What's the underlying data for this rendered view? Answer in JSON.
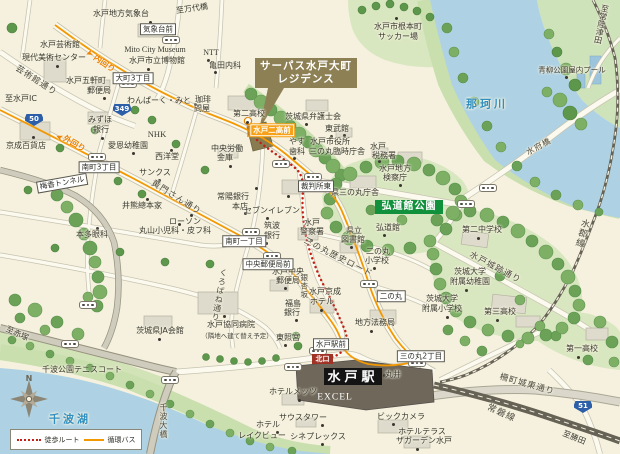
{
  "badges": {
    "property_line1": "サーパス水戸大町",
    "property_line2": "レジデンス",
    "kodokan_park": "弘道館公園",
    "station": "水戸駅",
    "north_exit": "北口"
  },
  "legend": {
    "walk_label": "徒歩ルート",
    "bus_label": "循環バス"
  },
  "compass": {
    "north_label": "N"
  },
  "colors": {
    "water": "#aed2e4",
    "park": "#d9e7c0",
    "bus_route": "#f39800",
    "walk_route": "#c22017",
    "property_badge": "#8d8054",
    "park_badge": "#12913d",
    "route_shield": "#2d5fa8",
    "station_badge": "#141414",
    "north_exit_badge": "#a03326"
  },
  "route_shields": [
    {
      "num": "50",
      "x": 34,
      "y": 120
    },
    {
      "num": "349",
      "x": 122,
      "y": 110
    },
    {
      "num": "51",
      "x": 583,
      "y": 407
    }
  ],
  "bus_pills": [
    [
      171,
      40
    ],
    [
      128,
      84
    ],
    [
      97,
      157
    ],
    [
      281,
      164
    ],
    [
      313,
      177
    ],
    [
      488,
      188
    ],
    [
      466,
      204
    ],
    [
      251,
      232
    ],
    [
      272,
      256
    ],
    [
      369,
      284
    ],
    [
      417,
      363
    ],
    [
      318,
      351
    ],
    [
      88,
      305
    ],
    [
      70,
      344
    ],
    [
      170,
      380
    ],
    [
      293,
      367
    ]
  ],
  "poi_dots": [
    [
      150,
      22
    ],
    [
      57,
      66
    ],
    [
      104,
      98
    ],
    [
      148,
      69
    ],
    [
      208,
      60
    ],
    [
      215,
      72
    ],
    [
      195,
      104
    ],
    [
      247,
      122
    ],
    [
      102,
      138
    ],
    [
      33,
      137
    ],
    [
      133,
      153
    ],
    [
      159,
      180
    ],
    [
      147,
      199
    ],
    [
      191,
      215
    ],
    [
      267,
      218
    ],
    [
      245,
      213
    ],
    [
      179,
      224
    ],
    [
      97,
      228
    ],
    [
      230,
      166
    ],
    [
      171,
      150
    ],
    [
      306,
      124
    ],
    [
      331,
      136
    ],
    [
      344,
      135
    ],
    [
      294,
      158
    ],
    [
      379,
      161
    ],
    [
      400,
      185
    ],
    [
      384,
      235
    ],
    [
      478,
      238
    ],
    [
      466,
      290
    ],
    [
      447,
      317
    ],
    [
      497,
      320
    ],
    [
      578,
      357
    ],
    [
      351,
      247
    ],
    [
      311,
      240
    ],
    [
      374,
      268
    ],
    [
      285,
      288
    ],
    [
      321,
      310
    ],
    [
      371,
      331
    ],
    [
      296,
      320
    ],
    [
      285,
      345
    ],
    [
      384,
      375
    ],
    [
      299,
      400
    ],
    [
      322,
      425
    ],
    [
      322,
      444
    ],
    [
      393,
      424
    ],
    [
      417,
      449
    ],
    [
      159,
      339
    ],
    [
      224,
      316
    ],
    [
      277,
      432
    ],
    [
      566,
      77
    ],
    [
      396,
      18
    ],
    [
      256,
      188
    ],
    [
      288,
      196
    ],
    [
      266,
      243
    ]
  ],
  "labels": [
    {
      "n": "met-observatory",
      "t": "水戸地方気象台",
      "x": 121,
      "y": 14
    },
    {
      "n": "to-bandaibashi",
      "t": "至万代橋",
      "x": 192,
      "y": 9,
      "r": -8
    },
    {
      "n": "art-tower-line1",
      "t": "水戸芸術館",
      "x": 60,
      "y": 45
    },
    {
      "n": "art-tower-line2",
      "t": "現代美術センター",
      "x": 54,
      "y": 58
    },
    {
      "n": "mito-city-museum-en",
      "t": "Mito City Museum",
      "x": 155,
      "y": 50,
      "c": "en"
    },
    {
      "n": "mito-city-museum",
      "t": "水戸市立博物館",
      "x": 157,
      "y": 61
    },
    {
      "n": "ntt",
      "t": "NTT",
      "x": 211,
      "y": 53,
      "c": "en"
    },
    {
      "n": "kameda-clinic",
      "t": "亀田内科",
      "x": 225,
      "y": 66
    },
    {
      "n": "uchimawari",
      "t": "内回り",
      "x": 104,
      "y": 64,
      "r": 35,
      "c": "orange"
    },
    {
      "n": "uchimawari-arrow",
      "t": "➤",
      "x": 89,
      "y": 52,
      "r": 160,
      "s": 9,
      "c": "orange"
    },
    {
      "n": "geijutsukan-dori",
      "t": "芸術館通り",
      "x": 36,
      "y": 81,
      "s": 8.5,
      "r": 33,
      "c": "road"
    },
    {
      "n": "gokencho-po-line1",
      "t": "水戸五軒町",
      "x": 86,
      "y": 81
    },
    {
      "n": "gokencho-po-line2",
      "t": "郵便局",
      "x": 99,
      "y": 91
    },
    {
      "n": "to-mito-ic",
      "t": "至水戸IC",
      "x": 21,
      "y": 99
    },
    {
      "n": "wanpark-mito",
      "t": "わんぱーく・みと",
      "x": 159,
      "y": 101
    },
    {
      "n": "coffee-tonya-line1",
      "t": "珈琲",
      "x": 203,
      "y": 100
    },
    {
      "n": "coffee-tonya-line2",
      "t": "問屋",
      "x": 202,
      "y": 109
    },
    {
      "n": "daini-hs",
      "t": "第二高校",
      "x": 249,
      "y": 114
    },
    {
      "n": "nemoto-soccer-line1",
      "t": "水戸市根本町",
      "x": 398,
      "y": 27
    },
    {
      "n": "nemoto-soccer-line2",
      "t": "サッカー場",
      "x": 398,
      "y": 37
    },
    {
      "n": "to-hitachitsuda",
      "t": "至常陸津田",
      "x": 601,
      "y": 24,
      "c": "v",
      "r": 12
    },
    {
      "n": "aoyagi-pool",
      "t": "青柳公園屋内プール",
      "x": 572,
      "y": 70,
      "s": 7.5
    },
    {
      "n": "naka-river-name",
      "t": "那珂川",
      "x": 487,
      "y": 104,
      "s": 11,
      "c": "blue"
    },
    {
      "n": "mizuho-line1",
      "t": "みずほ",
      "x": 100,
      "y": 120
    },
    {
      "n": "mizuho-line2",
      "t": "銀行",
      "x": 101,
      "y": 130
    },
    {
      "n": "keisei-dept",
      "t": "京成百貨店",
      "x": 26,
      "y": 146
    },
    {
      "n": "nhk",
      "t": "NHK",
      "x": 157,
      "y": 134,
      "s": 8.5,
      "c": "en"
    },
    {
      "n": "seiyodo",
      "t": "西洋堂",
      "x": 167,
      "y": 157
    },
    {
      "n": "chuo-rokin-line1",
      "t": "中央労働",
      "x": 227,
      "y": 149
    },
    {
      "n": "chuo-rokin-line2",
      "t": "金庫",
      "x": 225,
      "y": 158
    },
    {
      "n": "aion-kindergarten",
      "t": "愛恩幼稚園",
      "x": 128,
      "y": 146
    },
    {
      "n": "sotomawari",
      "t": "外回り",
      "x": 74,
      "y": 144,
      "r": 30,
      "c": "orange"
    },
    {
      "n": "sotomawari-arrow",
      "t": "➤",
      "x": 60,
      "y": 136,
      "r": 205,
      "s": 9,
      "c": "orange"
    },
    {
      "n": "ibaraki-bar-assoc",
      "t": "茨城県弁護士会",
      "x": 313,
      "y": 117
    },
    {
      "n": "tobukan",
      "t": "東武館",
      "x": 337,
      "y": 129
    },
    {
      "n": "cityhall-line1",
      "t": "水戸市役所",
      "x": 330,
      "y": 142
    },
    {
      "n": "cityhall-line2",
      "t": "三の丸臨時庁舎",
      "x": 337,
      "y": 152
    },
    {
      "n": "yasu-dental-line1",
      "t": "やす",
      "x": 297,
      "y": 142
    },
    {
      "n": "yasu-dental-line2",
      "t": "歯科",
      "x": 297,
      "y": 152
    },
    {
      "n": "mito-tax-line1",
      "t": "水戸",
      "x": 378,
      "y": 147
    },
    {
      "n": "mito-tax-line2",
      "t": "税務署",
      "x": 384,
      "y": 156
    },
    {
      "n": "kensatsucho-line1",
      "t": "水戸地方",
      "x": 395,
      "y": 169
    },
    {
      "n": "kensatsucho-line2",
      "t": "検察庁",
      "x": 395,
      "y": 178
    },
    {
      "n": "suifubashi",
      "t": "水府橋",
      "x": 539,
      "y": 147,
      "r": -28,
      "c": "road"
    },
    {
      "n": "suigun-line-name",
      "t": "水郡線",
      "x": 581,
      "y": 233,
      "s": 9,
      "c": "v road",
      "r": 15
    },
    {
      "n": "komon-dori",
      "t": "黄門さん通り",
      "x": 176,
      "y": 198,
      "s": 8.5,
      "r": 32,
      "c": "road"
    },
    {
      "n": "sunkus",
      "t": "サンクス",
      "x": 155,
      "y": 173
    },
    {
      "n": "ikuma",
      "t": "井熊總本家",
      "x": 142,
      "y": 206
    },
    {
      "n": "joyo-bank-line1",
      "t": "常陽銀行",
      "x": 233,
      "y": 197
    },
    {
      "n": "joyo-bank-line2",
      "t": "本店",
      "x": 240,
      "y": 207
    },
    {
      "n": "seven-eleven",
      "t": "セブンイレブン",
      "x": 272,
      "y": 211
    },
    {
      "n": "lawson",
      "t": "ローソン",
      "x": 185,
      "y": 222
    },
    {
      "n": "maruyama-clinic",
      "t": "丸山小児科・皮フ科",
      "x": 175,
      "y": 231
    },
    {
      "n": "honda-eye",
      "t": "本多眼科",
      "x": 92,
      "y": 235
    },
    {
      "n": "tsukuba-bank-line1",
      "t": "筑波",
      "x": 272,
      "y": 226
    },
    {
      "n": "tsukuba-bank-line2",
      "t": "銀行",
      "x": 272,
      "y": 236
    },
    {
      "n": "ken-sannomaru",
      "t": "県三の丸庁舎",
      "x": 355,
      "y": 193
    },
    {
      "n": "kodokan",
      "t": "弘道館",
      "x": 388,
      "y": 228
    },
    {
      "n": "daini-jhs",
      "t": "第二中学校",
      "x": 482,
      "y": 230
    },
    {
      "n": "joseki-dori",
      "t": "水戸城跡通り",
      "x": 495,
      "y": 268,
      "s": 8.5,
      "r": 28,
      "c": "road"
    },
    {
      "n": "ibadai-kg-line1",
      "t": "茨城大学",
      "x": 470,
      "y": 272
    },
    {
      "n": "ibadai-kg-line2",
      "t": "附属幼稚園",
      "x": 470,
      "y": 282
    },
    {
      "n": "ibadai-es-line1",
      "t": "茨城大学",
      "x": 442,
      "y": 299
    },
    {
      "n": "ibadai-es-line2",
      "t": "附属小学校",
      "x": 442,
      "y": 309
    },
    {
      "n": "daisan-hs",
      "t": "第三高校",
      "x": 500,
      "y": 312
    },
    {
      "n": "daiichi-hs",
      "t": "第一高校",
      "x": 582,
      "y": 349
    },
    {
      "n": "pref-library-line1",
      "t": "県立",
      "x": 354,
      "y": 231
    },
    {
      "n": "pref-library-line2",
      "t": "図書館",
      "x": 353,
      "y": 240
    },
    {
      "n": "mito-police-line1",
      "t": "水戸",
      "x": 312,
      "y": 223
    },
    {
      "n": "mito-police-line2",
      "t": "警察署",
      "x": 312,
      "y": 232
    },
    {
      "n": "sannomaru-history-road",
      "t": "三の丸歴史ロード",
      "x": 338,
      "y": 258,
      "s": 8.5,
      "r": 27,
      "c": "road"
    },
    {
      "n": "ninomaru-es-line1",
      "t": "二の丸",
      "x": 378,
      "y": 252
    },
    {
      "n": "ninomaru-es-line2",
      "t": "小学校",
      "x": 377,
      "y": 261
    },
    {
      "n": "central-po-line1",
      "t": "水戸中央",
      "x": 288,
      "y": 272
    },
    {
      "n": "central-po-line2",
      "t": "郵便局",
      "x": 288,
      "y": 281
    },
    {
      "n": "keisei-hotel-line1",
      "t": "水戸京成",
      "x": 325,
      "y": 292
    },
    {
      "n": "keisei-hotel-line2",
      "t": "ホテル",
      "x": 322,
      "y": 302
    },
    {
      "n": "legal-affairs",
      "t": "地方法務局",
      "x": 375,
      "y": 323
    },
    {
      "n": "fukushima-bank-line1",
      "t": "福島",
      "x": 293,
      "y": 304
    },
    {
      "n": "fukushima-bank-line2",
      "t": "銀行",
      "x": 292,
      "y": 313
    },
    {
      "n": "toshogu",
      "t": "東照宮",
      "x": 288,
      "y": 338
    },
    {
      "n": "ginkozaka",
      "t": "銀杏坂",
      "x": 304,
      "y": 286,
      "s": 7.5,
      "c": "v road"
    },
    {
      "n": "marui",
      "t": "丸井",
      "x": 393,
      "y": 375
    },
    {
      "n": "excel",
      "t": "EXCEL",
      "x": 335,
      "y": 398,
      "s": 9.5,
      "c": "white en"
    },
    {
      "n": "hotel-mets",
      "t": "ホテルメッツ",
      "x": 293,
      "y": 392
    },
    {
      "n": "south-tower",
      "t": "サウスタワー",
      "x": 303,
      "y": 418
    },
    {
      "n": "cineplex",
      "t": "シネプレックス",
      "x": 318,
      "y": 437
    },
    {
      "n": "bic-camera",
      "t": "ビックカメラ",
      "x": 401,
      "y": 417
    },
    {
      "n": "hotel-terrace-line1",
      "t": "ホテルテラス",
      "x": 422,
      "y": 432
    },
    {
      "n": "hotel-terrace-line2",
      "t": "ザガーデン水戸",
      "x": 424,
      "y": 441
    },
    {
      "n": "joban-line-name",
      "t": "常磐線",
      "x": 501,
      "y": 414,
      "s": 9,
      "r": 24,
      "c": "road"
    },
    {
      "n": "sakumachi-joto-dori",
      "t": "柵町城東通り",
      "x": 527,
      "y": 385,
      "s": 8.5,
      "r": 16,
      "c": "road"
    },
    {
      "n": "to-katsuta",
      "t": "至勝田",
      "x": 574,
      "y": 438,
      "r": 22
    },
    {
      "n": "ja-kaikan",
      "t": "茨城県JA会館",
      "x": 160,
      "y": 331
    },
    {
      "n": "kyodo-hospital",
      "t": "水戸協同病院",
      "x": 231,
      "y": 325
    },
    {
      "n": "kyodo-hospital-note",
      "t": "（隣地へ建て替え予定）",
      "x": 237,
      "y": 336,
      "s": 6.5,
      "c": "note"
    },
    {
      "n": "kurobane-dori",
      "t": "くろばね通り",
      "x": 219,
      "y": 295,
      "c": "v road",
      "r": 10
    },
    {
      "n": "senba-tennis",
      "t": "千波公園テニスコート",
      "x": 82,
      "y": 370
    },
    {
      "n": "to-akatsuka",
      "t": "至赤塚",
      "x": 17,
      "y": 334,
      "r": 25
    },
    {
      "n": "lake-senba-name",
      "t": "千波湖",
      "x": 70,
      "y": 419,
      "s": 11,
      "c": "blue"
    },
    {
      "n": "senba-ohashi",
      "t": "千波大橋",
      "x": 163,
      "y": 421,
      "c": "v road"
    },
    {
      "n": "hotel-lakeview-line1",
      "t": "ホテル",
      "x": 268,
      "y": 425
    },
    {
      "n": "hotel-lakeview-line2",
      "t": "レイクビュー",
      "x": 262,
      "y": 436
    },
    {
      "n": "baiko-tunnel",
      "t": "梅香トンネル",
      "x": 62,
      "y": 183,
      "s": 7.5,
      "c": "box",
      "r": -10
    },
    {
      "n": "busstop-kishodai-mae",
      "t": "気象台前",
      "x": 158,
      "y": 29,
      "s": 7.5,
      "c": "box"
    },
    {
      "n": "busstop-omachi-3",
      "t": "大町3丁目",
      "x": 133,
      "y": 78,
      "s": 7.5,
      "c": "box"
    },
    {
      "n": "busstop-minamimachi-3",
      "t": "南町3丁目",
      "x": 99,
      "y": 167,
      "s": 7.5,
      "c": "box"
    },
    {
      "n": "busstop-minamimachi-1",
      "t": "南町一丁目",
      "x": 244,
      "y": 241,
      "s": 7.5,
      "c": "box"
    },
    {
      "n": "busstop-saibansho-higashi",
      "t": "裁判所東",
      "x": 316,
      "y": 186,
      "s": 7.5,
      "c": "box"
    },
    {
      "n": "busstop-chuo-yubinkyoku-mae",
      "t": "中央郵便局前",
      "x": 268,
      "y": 264,
      "s": 7.5,
      "c": "box"
    },
    {
      "n": "busstop-ninomaru",
      "t": "二の丸",
      "x": 391,
      "y": 296,
      "s": 7.5,
      "c": "box"
    },
    {
      "n": "busstop-sannomaru-2",
      "t": "三の丸2丁目",
      "x": 421,
      "y": 356,
      "s": 7.5,
      "c": "box"
    },
    {
      "n": "busstop-mitoekimae",
      "t": "水戸駅前",
      "x": 331,
      "y": 344,
      "s": 7.5,
      "c": "box"
    },
    {
      "n": "busstop-mito-niko-mae",
      "t": "水戸二高前",
      "x": 272,
      "y": 130,
      "s": 7.5,
      "c": "obox"
    }
  ]
}
